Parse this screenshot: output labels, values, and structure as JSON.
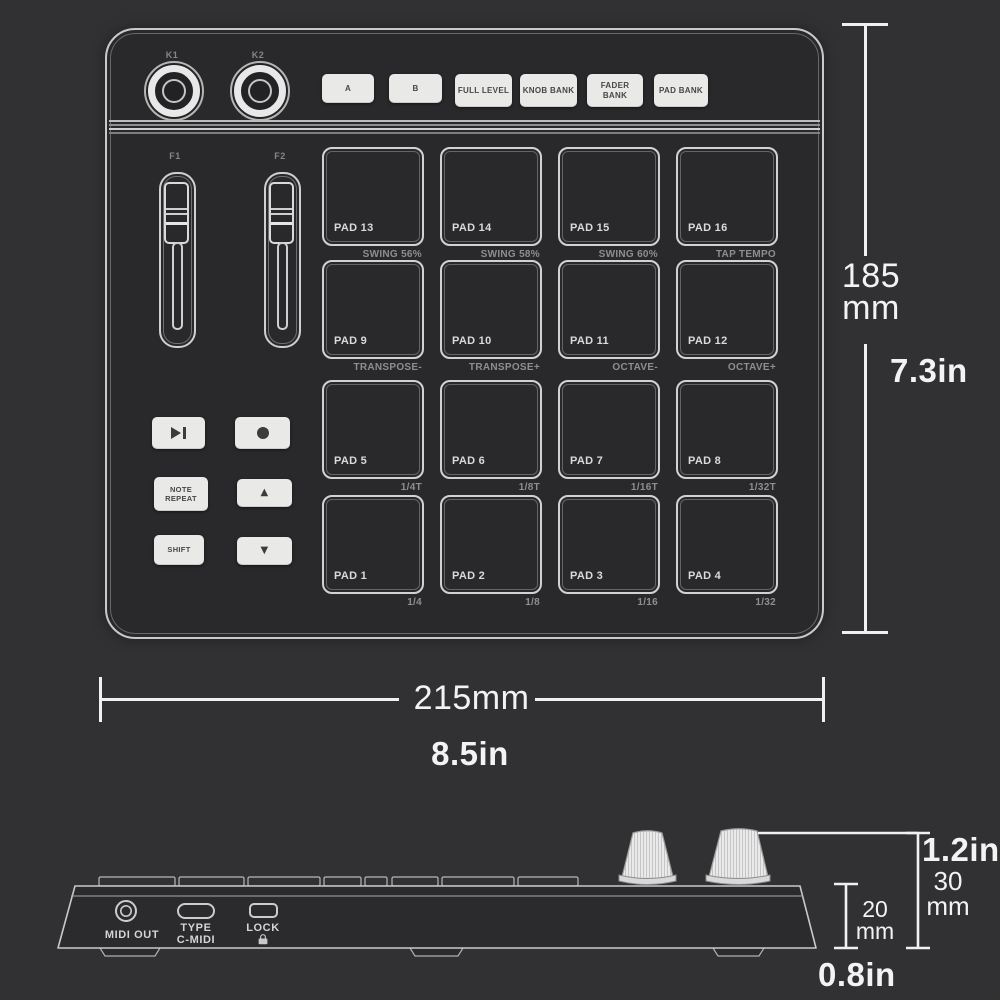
{
  "top_view": {
    "knob_labels": [
      "K1",
      "K2"
    ],
    "buttons": [
      "A",
      "B",
      "FULL LEVEL",
      "KNOB BANK",
      "FADER BANK",
      "PAD BANK"
    ],
    "fader_labels": [
      "F1",
      "F2"
    ],
    "left_buttons": {
      "note_repeat": "NOTE REPEAT",
      "shift": "SHIFT",
      "up_glyph": "▲",
      "down_glyph": "▼"
    },
    "pads": [
      {
        "name": "PAD 13",
        "sub": "SWING 56%"
      },
      {
        "name": "PAD 14",
        "sub": "SWING 58%"
      },
      {
        "name": "PAD 15",
        "sub": "SWING 60%"
      },
      {
        "name": "PAD 16",
        "sub": "TAP TEMPO"
      },
      {
        "name": "PAD 9",
        "sub": "TRANSPOSE-"
      },
      {
        "name": "PAD 10",
        "sub": "TRANSPOSE+"
      },
      {
        "name": "PAD 11",
        "sub": "OCTAVE-"
      },
      {
        "name": "PAD 12",
        "sub": "OCTAVE+"
      },
      {
        "name": "PAD 5",
        "sub": "1/4T"
      },
      {
        "name": "PAD 6",
        "sub": "1/8T"
      },
      {
        "name": "PAD 7",
        "sub": "1/16T"
      },
      {
        "name": "PAD 8",
        "sub": "1/32T"
      },
      {
        "name": "PAD 1",
        "sub": "1/4"
      },
      {
        "name": "PAD 2",
        "sub": "1/8"
      },
      {
        "name": "PAD 3",
        "sub": "1/16"
      },
      {
        "name": "PAD 4",
        "sub": "1/32"
      }
    ]
  },
  "dimensions": {
    "height_value": "185",
    "height_unit": "mm",
    "height_inches": "7.3in",
    "width_metric": "215mm",
    "width_inches": "8.5in",
    "depth_total_inches": "1.2in",
    "depth_total_value": "30",
    "depth_total_unit": "mm",
    "depth_body_value": "20",
    "depth_body_unit": "mm",
    "depth_body_inches": "0.8in"
  },
  "side_view": {
    "midi_out_label": "MIDI OUT",
    "usb_label_line1": "TYPE",
    "usb_label_line2": "C-MIDI",
    "lock_label": "LOCK"
  },
  "colors": {
    "background": "#313134",
    "device_fill": "#29292b",
    "outline": "#c9c9c9",
    "button_fill": "#e9e9e8",
    "dim_text": "#f3f3f3"
  }
}
